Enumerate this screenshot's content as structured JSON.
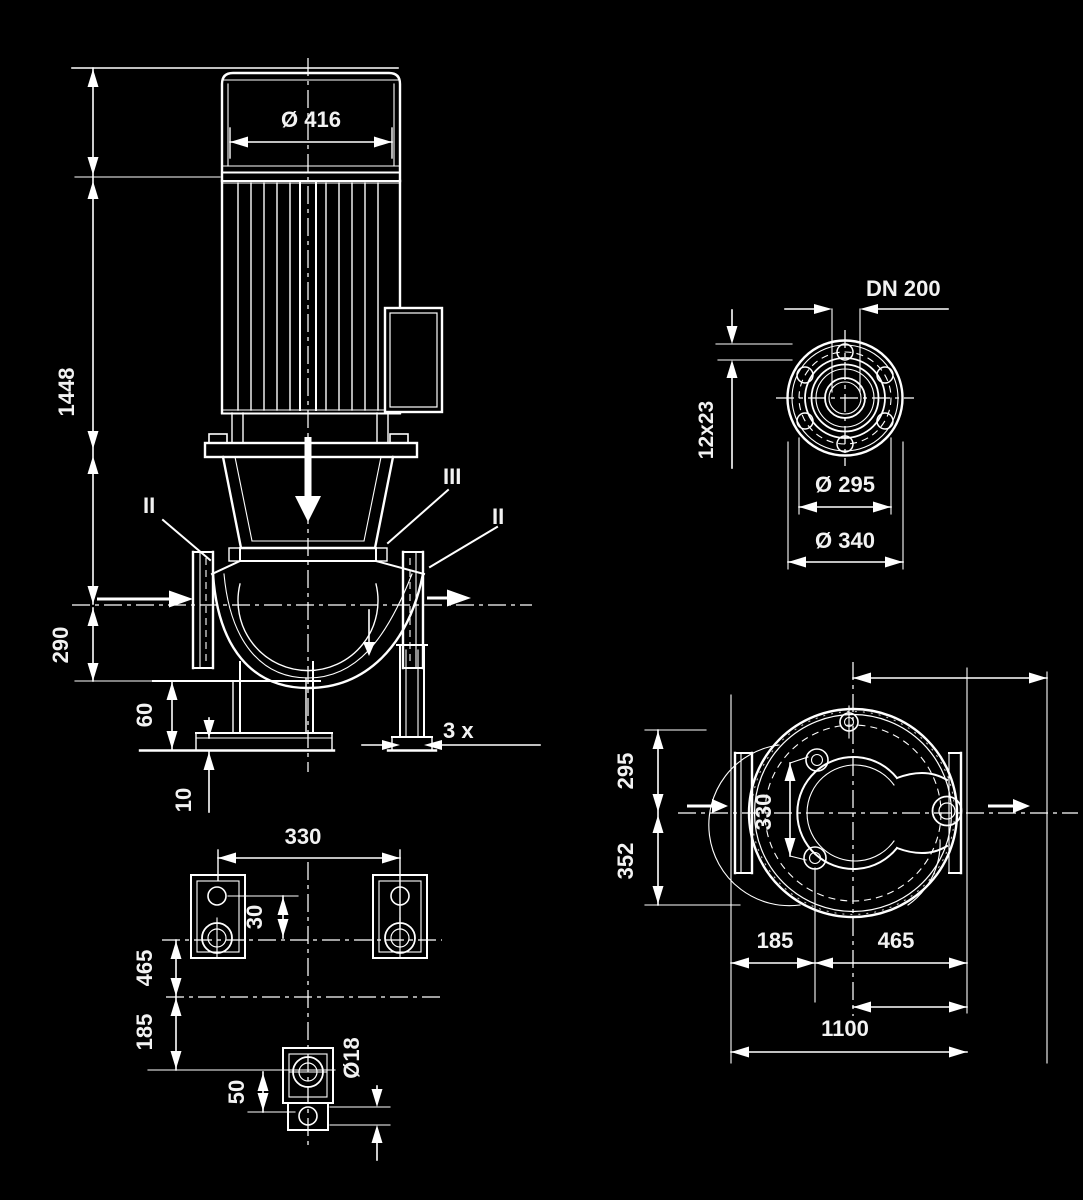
{
  "drawing": {
    "background_color": "#000000",
    "line_color": "#ffffff",
    "front_view": {
      "fan_diameter": "Ø 416",
      "height_total": "1448",
      "height_base": "290",
      "foot_height": "60",
      "plate_thickness": "10",
      "port_left": "II",
      "port_top": "III",
      "port_right": "II",
      "drain_count": "3 x"
    },
    "flange_view": {
      "nominal": "DN 200",
      "bolt_holes": "12x23",
      "bolt_circle": "Ø 295",
      "outer_diameter": "Ø 340"
    },
    "foot_view": {
      "bolt_spacing": "330",
      "hole_offset": "30",
      "dim_front": "465",
      "dim_rear": "185",
      "dim_side": "50",
      "hole_diameter": "Ø18"
    },
    "plan_view": {
      "width_suction": "295",
      "width_discharge": "352",
      "foot_spacing": "330",
      "dim_a": "185",
      "dim_b": "465",
      "length_total": "1100"
    }
  }
}
